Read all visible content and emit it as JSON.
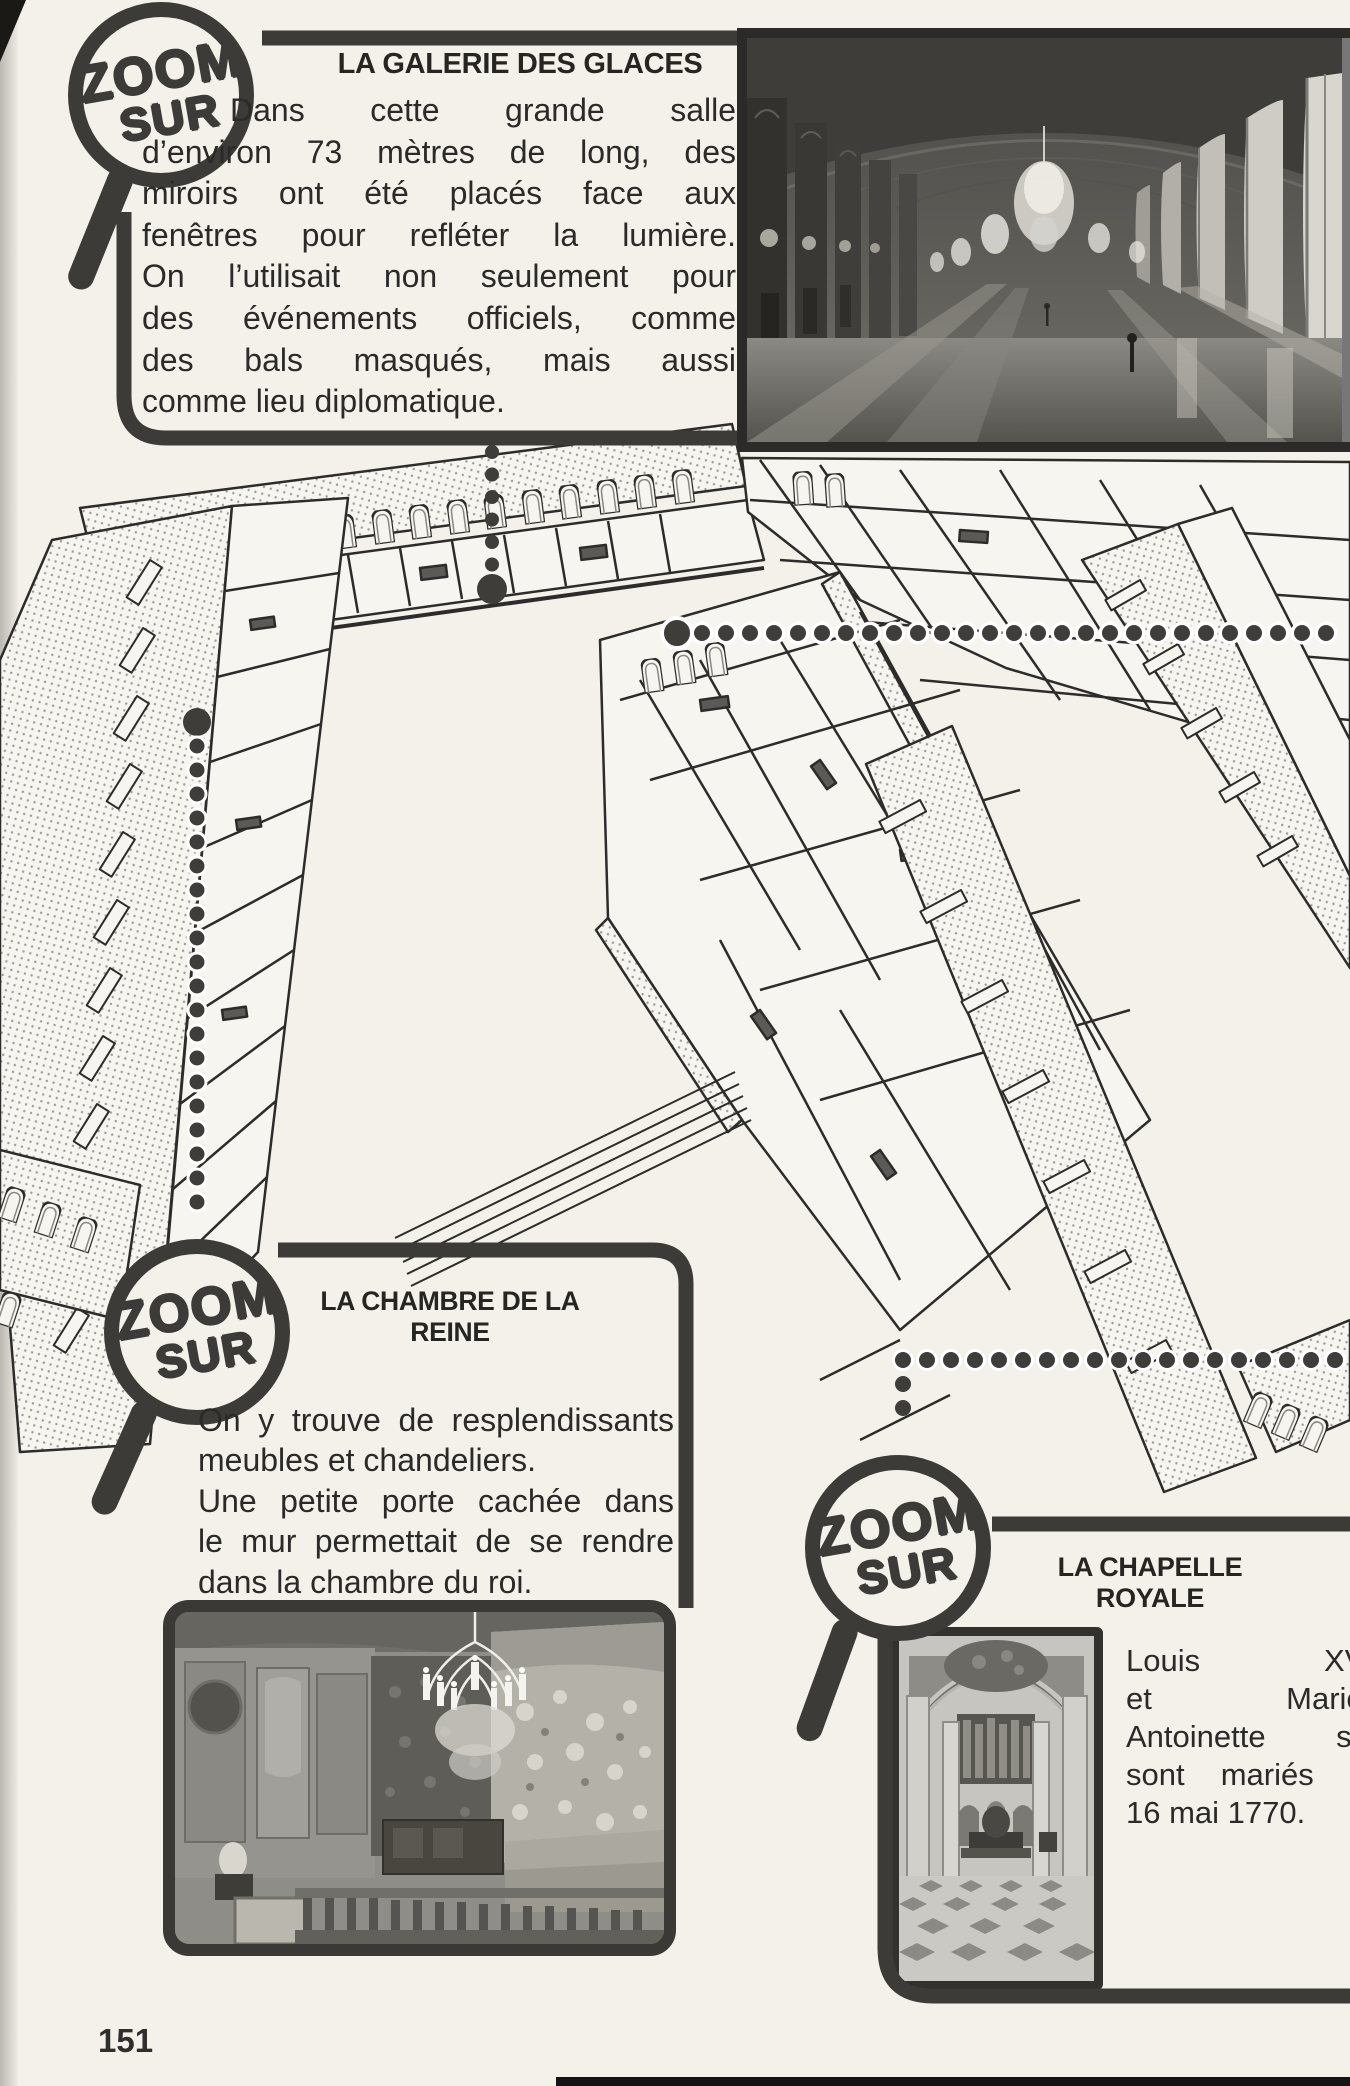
{
  "page": {
    "number": "151"
  },
  "badge_label": {
    "line1": "ZOOM",
    "line2": "SUR"
  },
  "sections": [
    {
      "title": "LA GALERIE DES GLACES",
      "paragraph_lines": [
        "Dans cette grande salle",
        "d’environ 73 mètres de long, des",
        "miroirs ont été placés face aux",
        "fenêtres pour refléter la lumière.",
        "On l’utilisait non seulement pour",
        "des événements officiels, comme",
        "des bals masqués, mais aussi",
        "comme lieu diplomatique."
      ]
    },
    {
      "title": "LA CHAMBRE DE LA REINE",
      "paragraph_lines": [
        "On y trouve de resplendissants",
        "meubles et chandeliers.",
        "Une petite porte cachée dans",
        "le mur permettait de se rendre",
        "dans la chambre du roi."
      ]
    },
    {
      "title": "LA CHAPELLE ROYALE",
      "paragraph_lines": [
        "Louis XVI",
        "et Marie-",
        "Antoinette s’y",
        "sont mariés le",
        "16 mai 1770."
      ]
    }
  ],
  "colors": {
    "paper": "#f4f1ea",
    "ink": "#3d3b38",
    "text": "#2b2a28"
  }
}
